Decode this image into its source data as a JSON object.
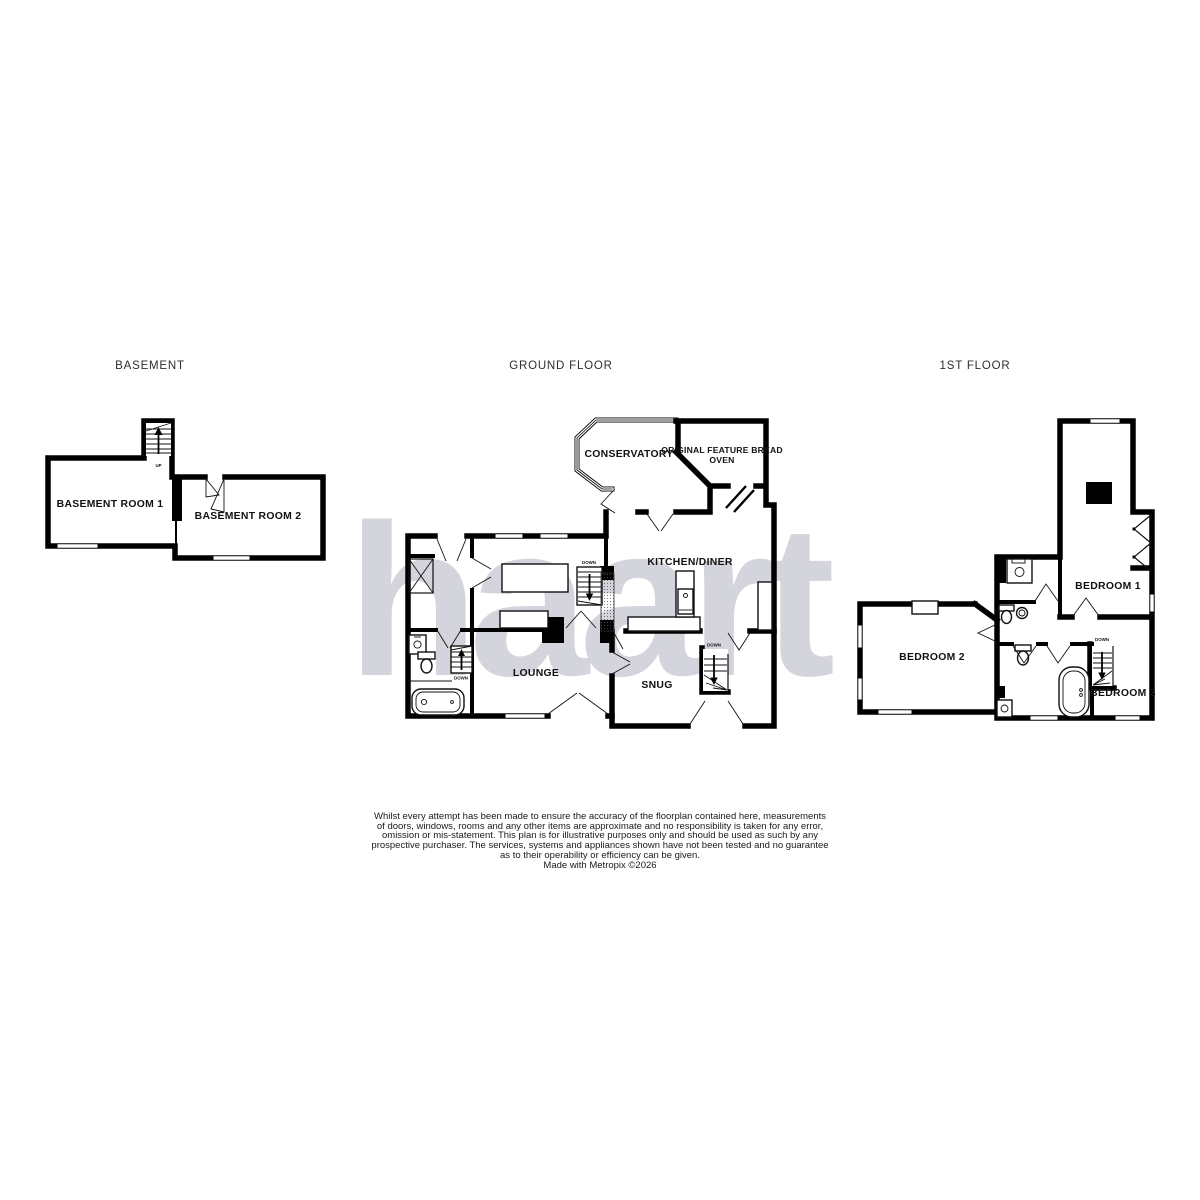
{
  "watermark": {
    "text": "haart",
    "color": "#d4d4dd"
  },
  "floors": {
    "basement": {
      "title": "BASEMENT",
      "rooms": {
        "room1": "BASEMENT ROOM 1",
        "room2": "BASEMENT ROOM 2"
      },
      "stairs": {
        "up": "UP"
      }
    },
    "ground": {
      "title": "GROUND FLOOR",
      "rooms": {
        "conservatory": "CONSERVATORY",
        "bread_oven_line1": "ORIGINAL FEATURE BREAD",
        "bread_oven_line2": "OVEN",
        "kitchen": "KITCHEN/DINER",
        "lounge": "LOUNGE",
        "snug": "SNUG"
      },
      "stairs": {
        "down": "DOWN"
      }
    },
    "first": {
      "title": "1ST FLOOR",
      "rooms": {
        "bedroom1": "BEDROOM 1",
        "bedroom2": "BEDROOM 2",
        "bedroom3": "BEDROOM 3"
      },
      "stairs": {
        "down": "DOWN"
      }
    }
  },
  "disclaimer": {
    "lines": [
      "Whilst every attempt has been made to ensure the accuracy of the floorplan contained here, measurements",
      "of doors, windows, rooms and any other items are approximate and no responsibility is taken for any error,",
      "omission or mis-statement. This plan is for illustrative purposes only and should be used as such by any",
      "prospective purchaser. The services, systems and appliances shown have not been tested and no guarantee",
      "as to their operability or efficiency can be given."
    ],
    "credit": "Made with Metropix ©2026"
  },
  "colors": {
    "wall": "#000000",
    "watermark": "#d4d4dd",
    "room_label": "#111111",
    "floor_title": "#2e2e2e",
    "disclaimer_text": "#1a1a1a",
    "background": "#ffffff"
  }
}
